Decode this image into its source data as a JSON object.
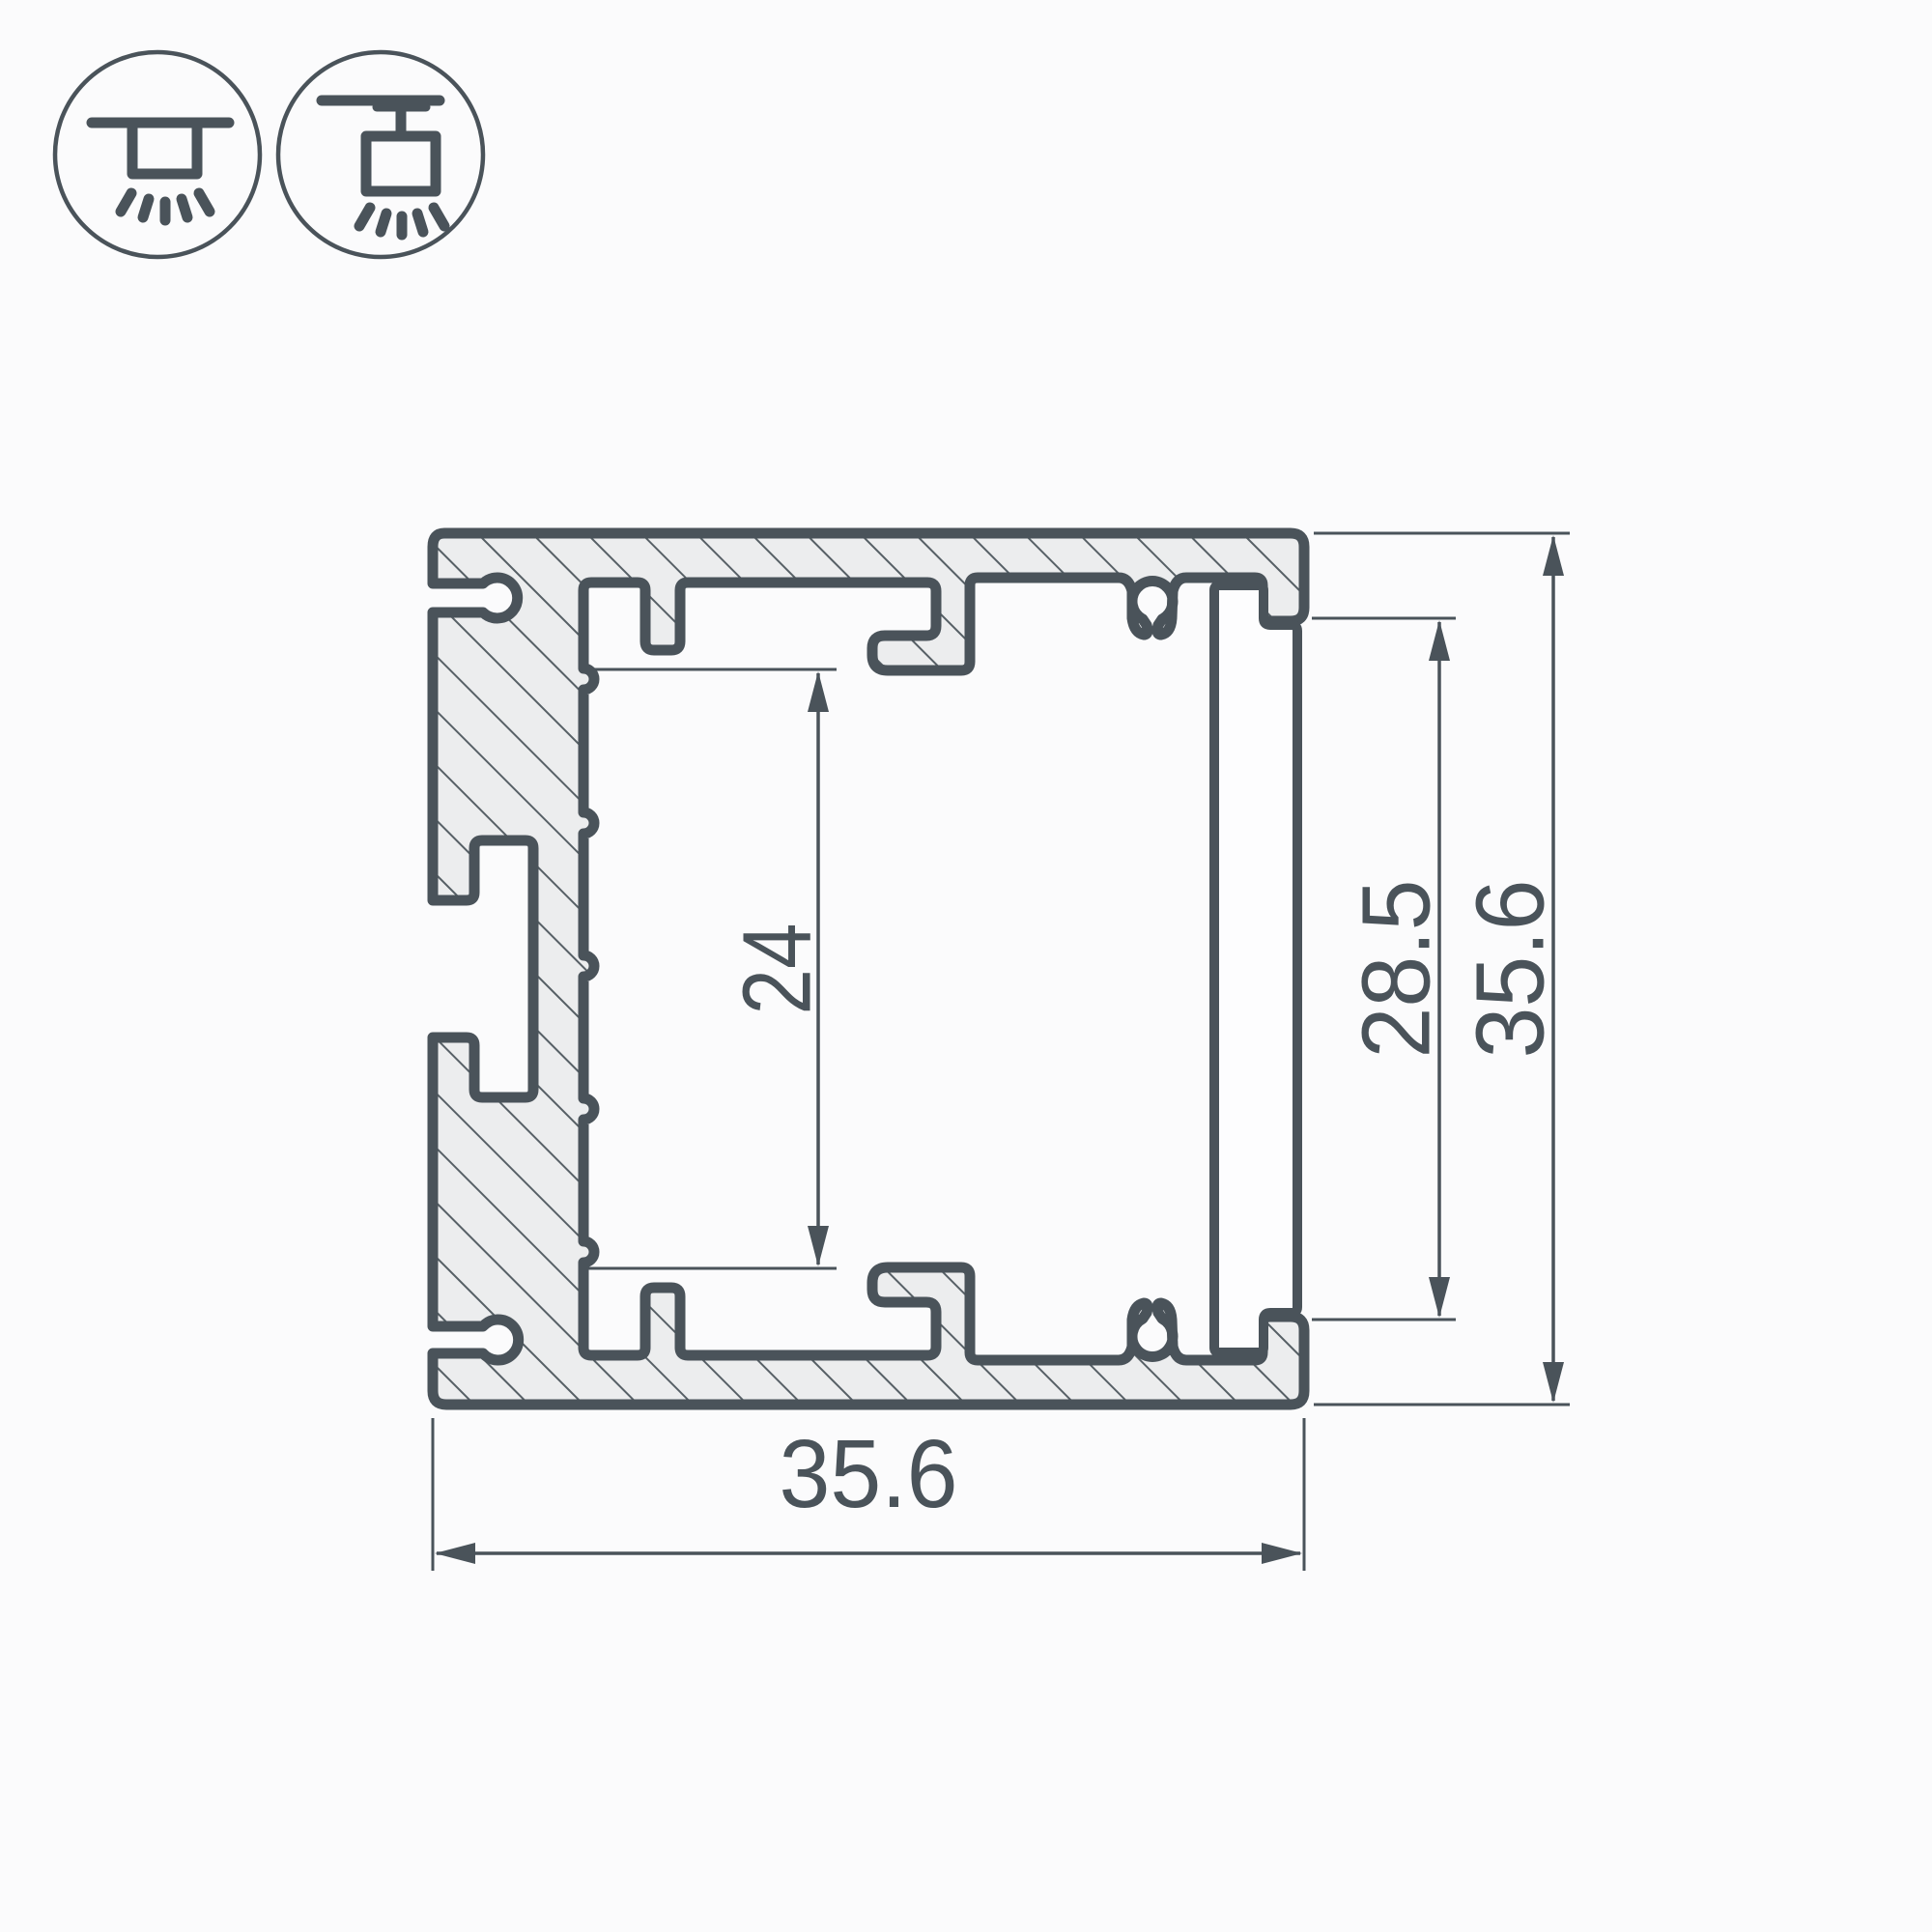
{
  "drawing": {
    "type": "led-profile-cross-section",
    "dimensions": {
      "inner_height_label": "24",
      "opening_height_label": "28.5",
      "overall_height_label": "35.6",
      "overall_width_label": "35.6"
    },
    "legend_icons": [
      {
        "label": "surface-mounted-luminaire"
      },
      {
        "label": "suspended-luminaire"
      }
    ],
    "colors": {
      "line": "#4A535A",
      "hatch_fill": "#ECEDEE",
      "background": "#FBFBFC",
      "plate_fill": "#FDFDFE"
    }
  }
}
